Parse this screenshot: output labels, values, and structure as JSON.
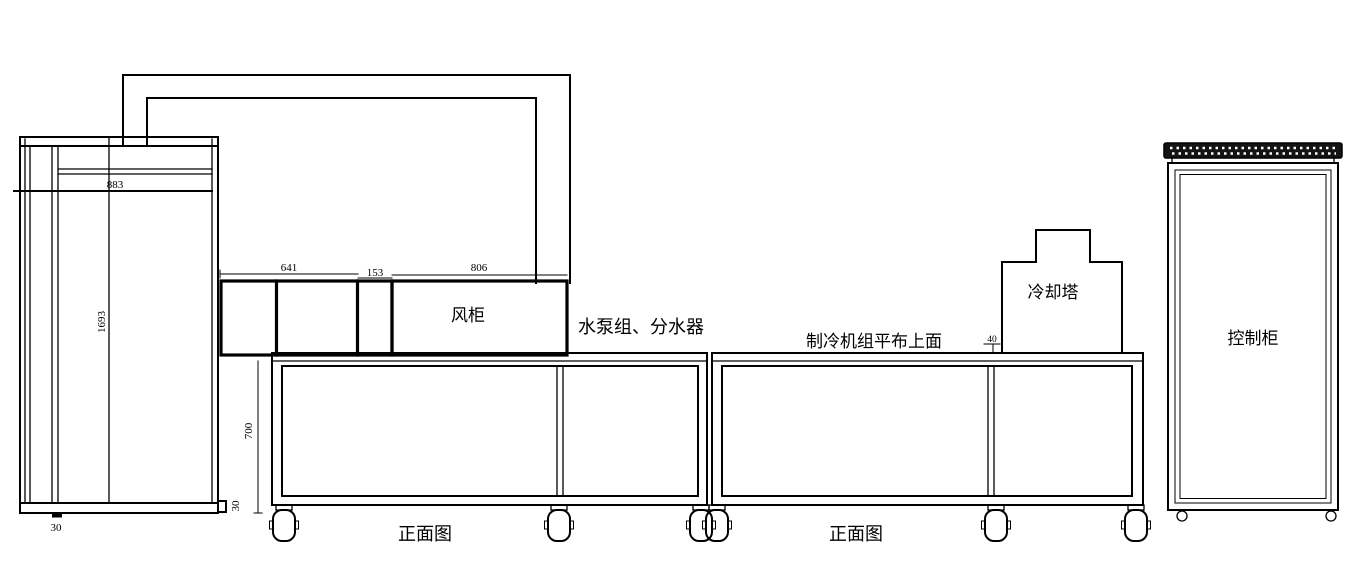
{
  "colors": {
    "line": "#000000",
    "background": "#ffffff",
    "grille_fill": "#141414"
  },
  "labels": {
    "fan_cabinet": "风柜",
    "pump_group": "水泵组、分水器",
    "chiller_top_note": "制冷机组平布上面",
    "cooling_tower": "冷却塔",
    "control_cabinet": "控制柜",
    "front_view_left": "正面图",
    "front_view_right": "正面图"
  },
  "dimensions": {
    "d883": "883",
    "d1693": "1693",
    "d30_base": "30",
    "d30_side": "30",
    "d700": "700",
    "d641": "641",
    "d153": "153",
    "d806": "806",
    "d40": "40"
  }
}
